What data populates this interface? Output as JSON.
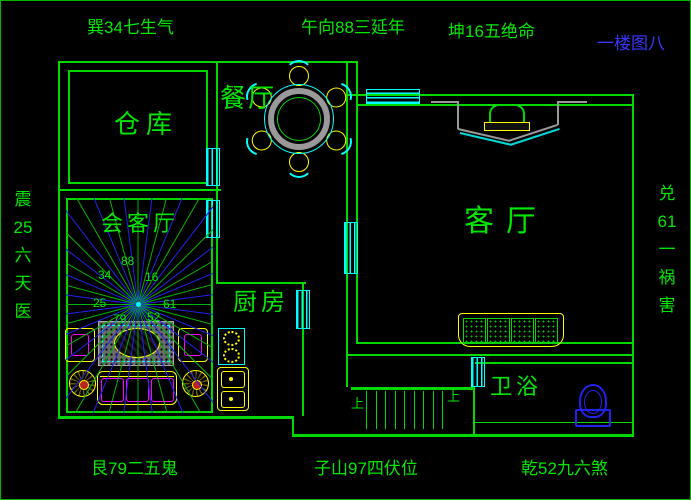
{
  "drawing_title": "一楼图八",
  "compass": {
    "top_left": "巽34七生气",
    "top_center": "午向88三延年",
    "top_right": "坤16五绝命",
    "bottom_left": "艮79二五鬼",
    "bottom_center": "子山97四伏位",
    "bottom_right": "乾52九六煞",
    "left_chars": [
      "震",
      "25",
      "六",
      "天",
      "医"
    ],
    "right_chars": [
      "兑",
      "61",
      "一",
      "祸",
      "害"
    ]
  },
  "rooms": {
    "storage_label": "仓库",
    "dining_label": "餐厅",
    "reception_label": "会客厅",
    "kitchen_label": "厨房",
    "living_label": "客厅",
    "bath_label": "卫浴"
  },
  "star_chart": {
    "numbers": [
      "34",
      "88",
      "16",
      "25",
      "61",
      "79",
      "52"
    ]
  },
  "stairs": {
    "up_label_left": "上",
    "up_label_right": "上"
  },
  "colors": {
    "wall_green": "#00d800",
    "text_green": "#00e800",
    "window_cyan": "#00ffff",
    "ray_blue": "#2222ee",
    "furniture_yellow": "#ffff00",
    "furniture_magenta": "#ff00ff",
    "table_gray": "#999999",
    "title_blue": "#3838ff"
  }
}
